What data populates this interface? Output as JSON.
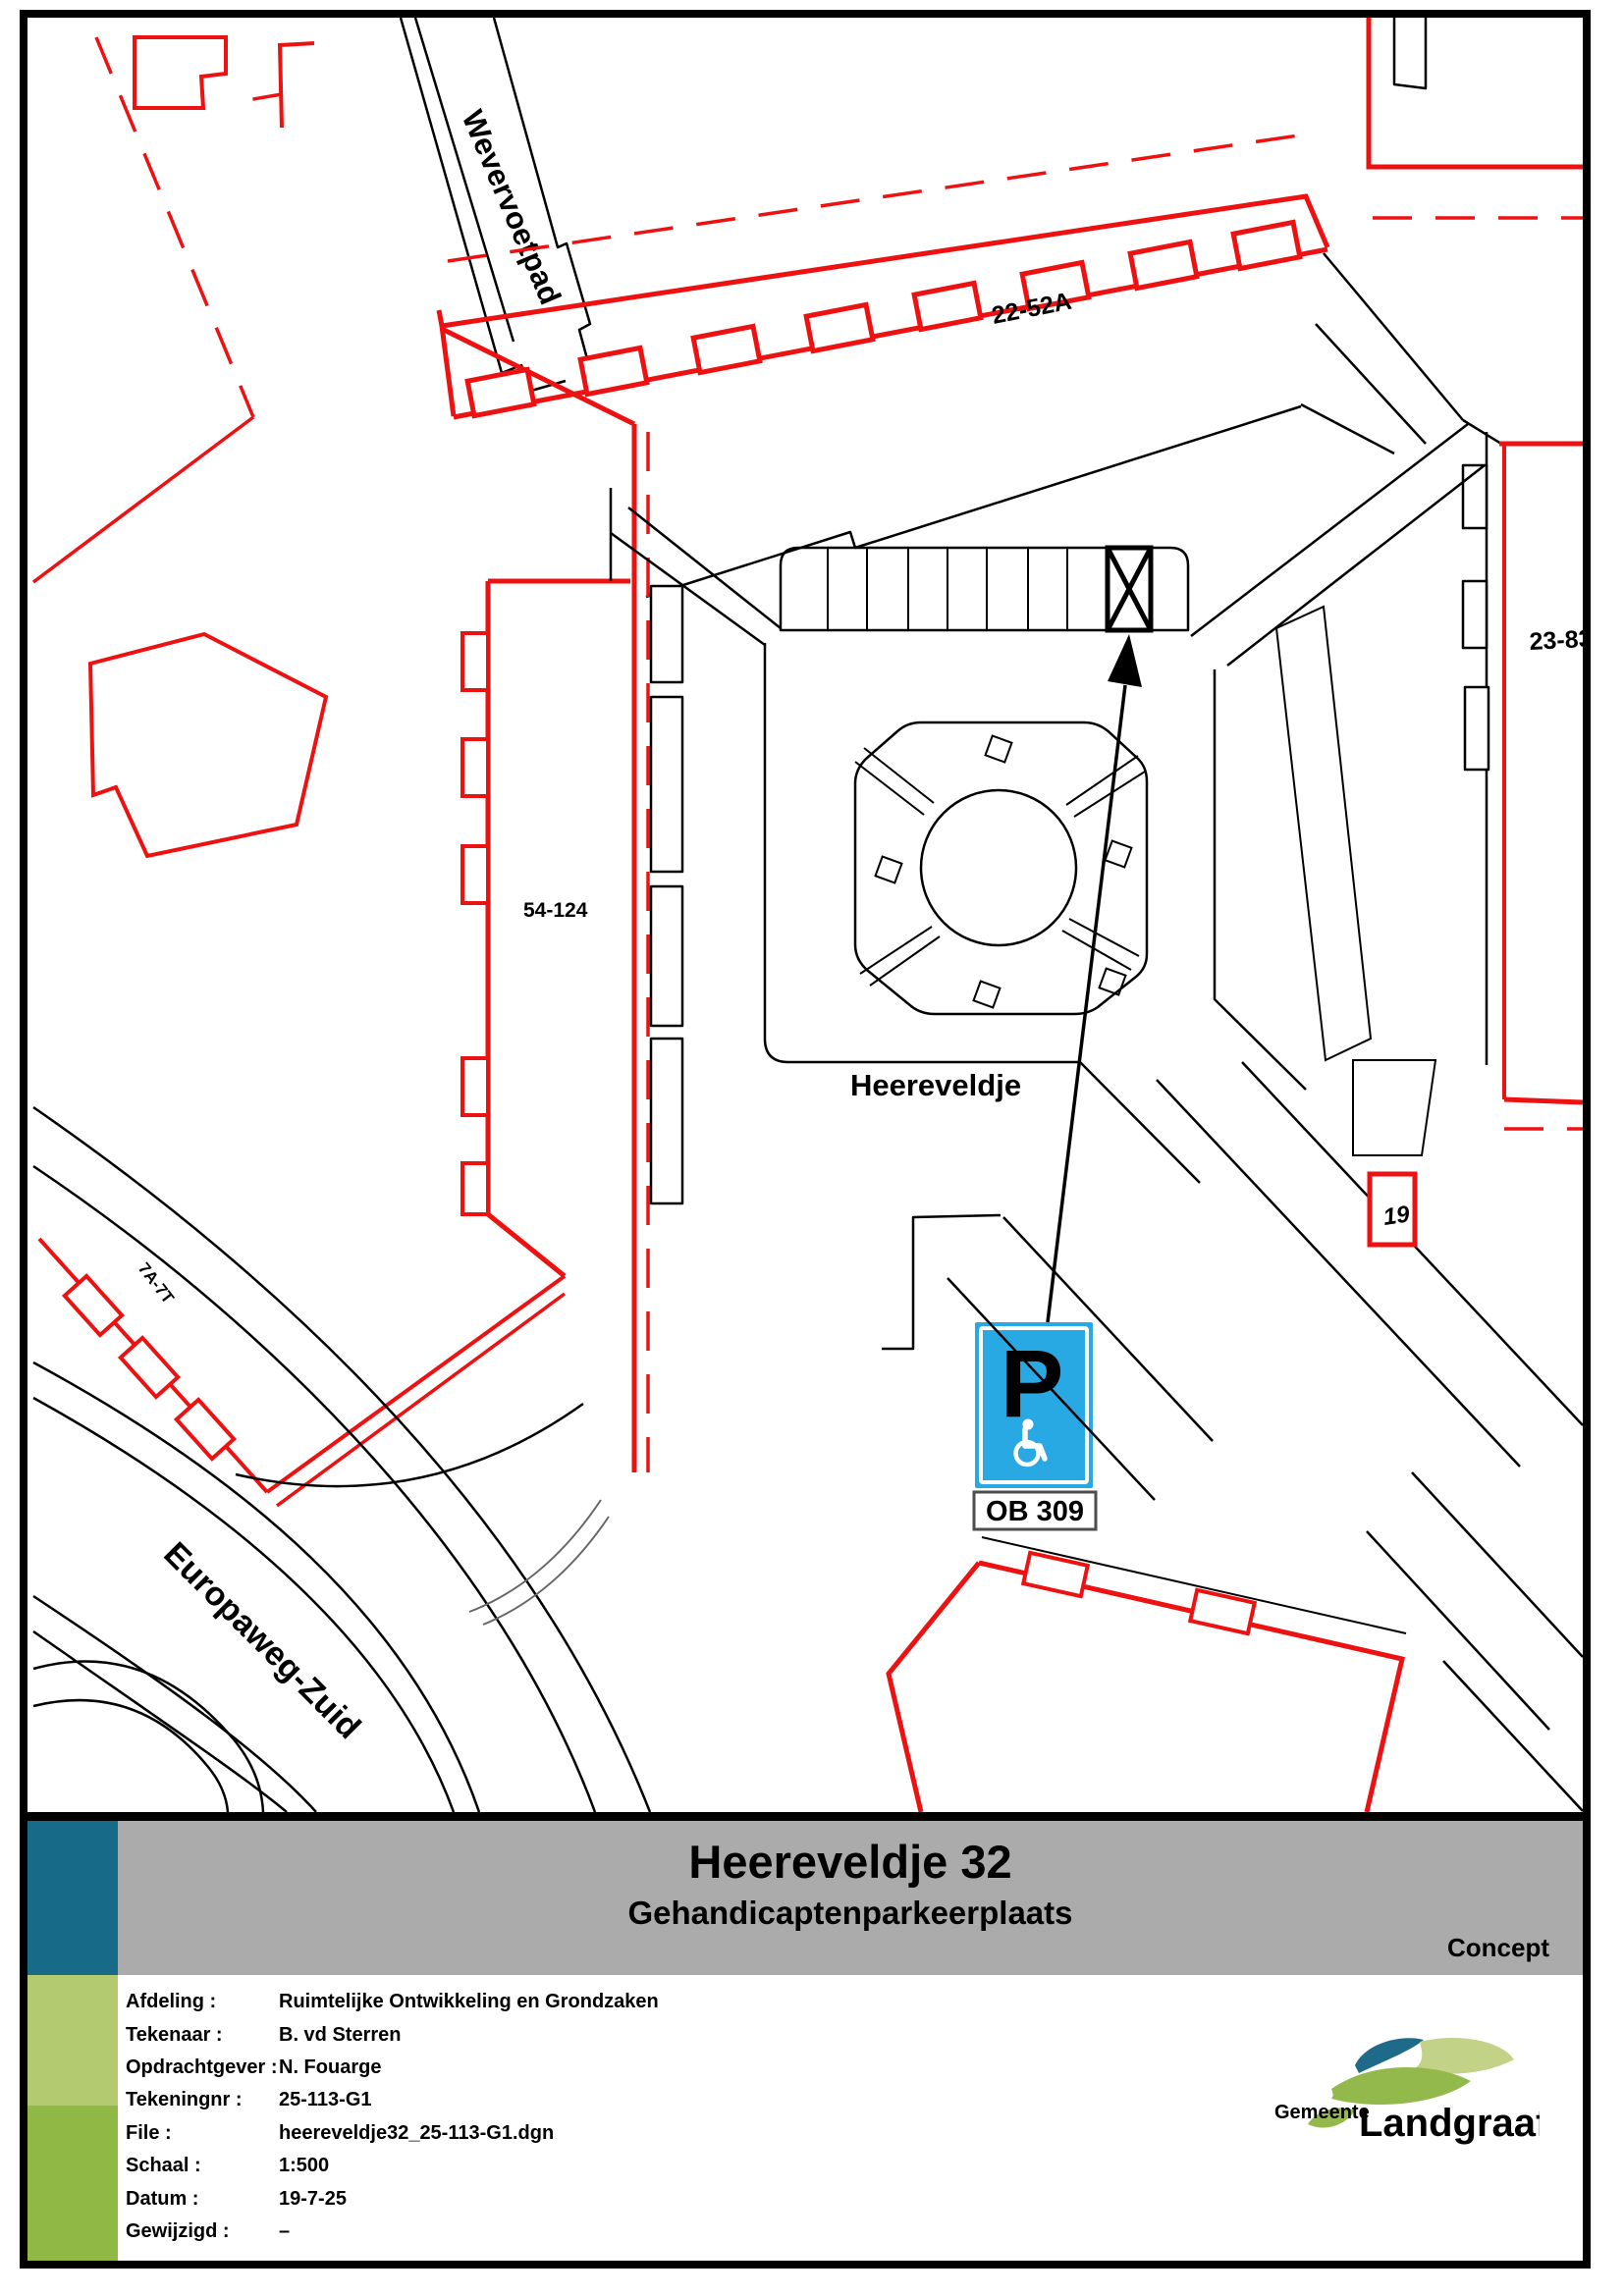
{
  "titleblock": {
    "title": "Heereveldje 32",
    "subtitle": "Gehandicaptenparkeerplaats",
    "status": "Concept",
    "fields": [
      {
        "label": "Afdeling :",
        "value": "Ruimtelijke Ontwikkeling en Grondzaken"
      },
      {
        "label": "Tekenaar :",
        "value": "B. vd Sterren"
      },
      {
        "label": "Opdrachtgever :",
        "value": "N. Fouarge"
      },
      {
        "label": "Tekeningnr :",
        "value": "25-113-G1"
      },
      {
        "label": "File :",
        "value": "heereveldje32_25-113-G1.dgn"
      },
      {
        "label": "Schaal :",
        "value": "1:500"
      },
      {
        "label": "Datum :",
        "value": "19-7-25"
      },
      {
        "label": "Gewijzigd :",
        "value": "–"
      }
    ],
    "logo": {
      "prefix": "Gemeente",
      "name": "Landgraaf"
    }
  },
  "map": {
    "labels": {
      "wevervoetpad": "Wevervoetpad",
      "europaweg_zuid": "Europaweg-Zuid",
      "heereveldje": "Heereveldje",
      "building_22_52a": "22-52A",
      "building_23_83": "23-83",
      "building_54_124": "54-124",
      "building_7a_7t": "7A-7T",
      "building_19": "19"
    },
    "parking_sign": {
      "letter": "P",
      "code": "OB 309",
      "icon": "wheelchair-icon"
    }
  },
  "colors": {
    "line-red": "#EE1111",
    "sign-blue": "#29A9E4",
    "band-gray": "#ABABAB",
    "bar-teal": "#186B88",
    "bar-light-green": "#B4CA70",
    "bar-green": "#8FB944",
    "logo-teal": "#135E80",
    "logo-dark-teal": "#1E6A89",
    "logo-light-green": "#C2D286",
    "logo-mid-green": "#93B94C"
  }
}
